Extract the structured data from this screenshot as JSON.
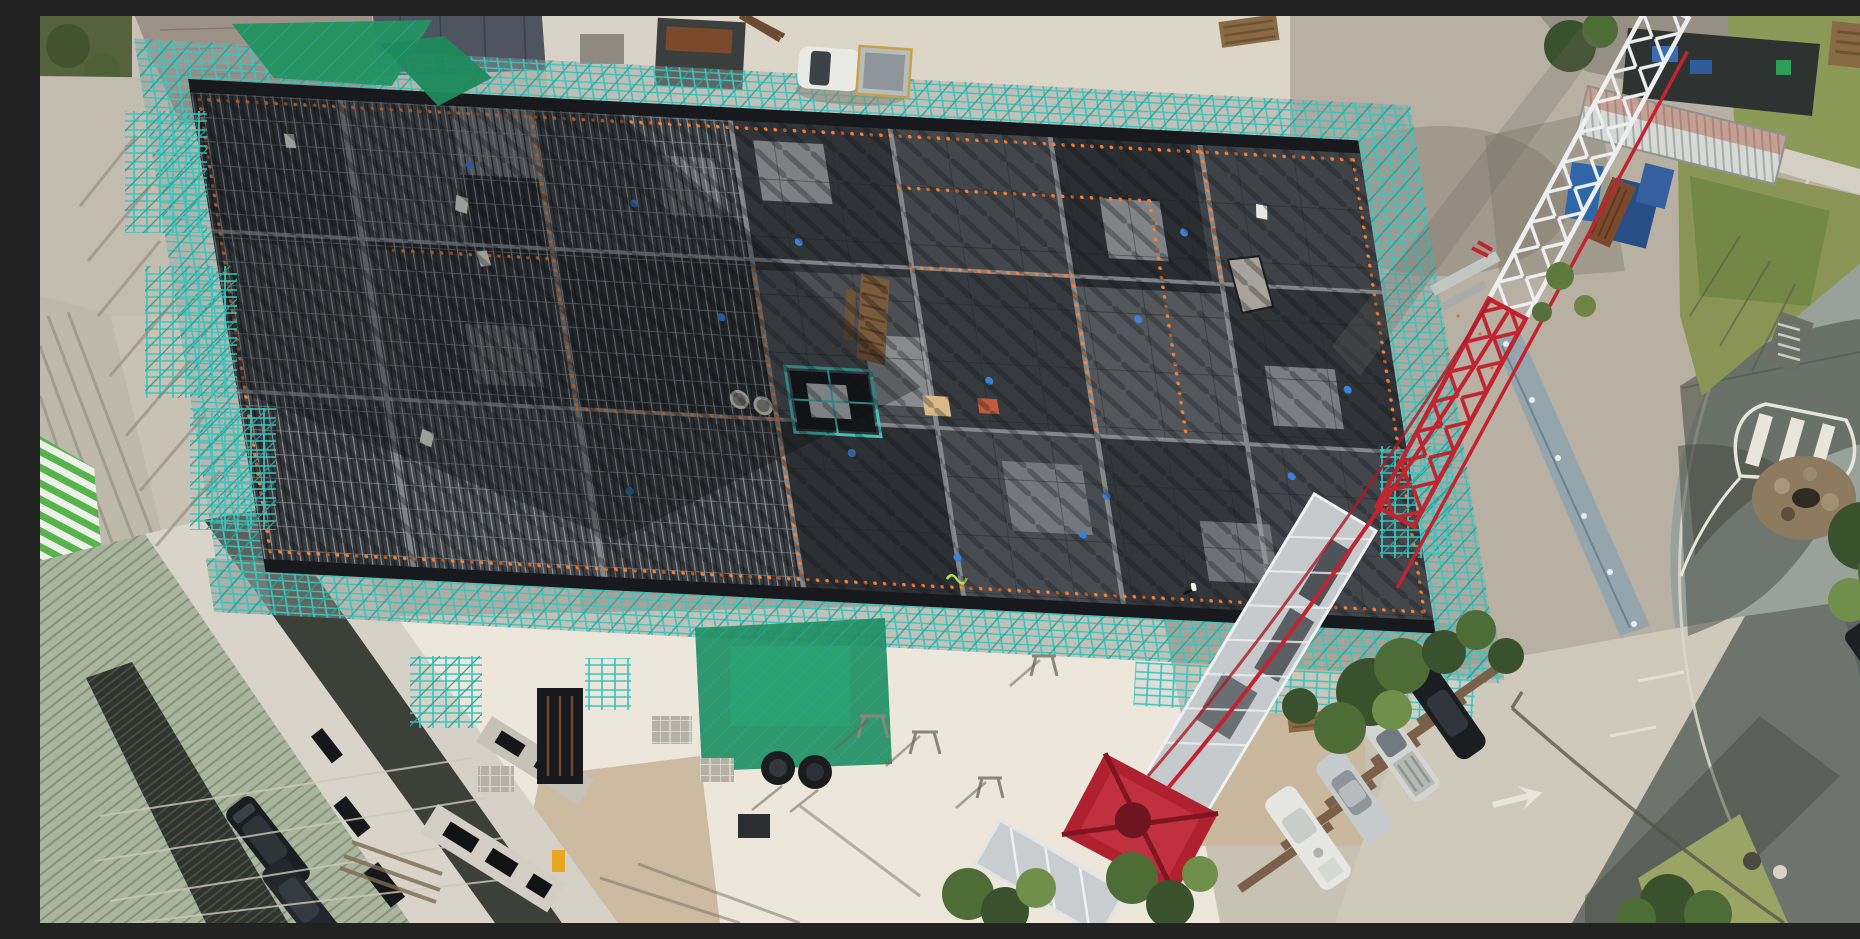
{
  "scene": {
    "type": "aerial-drone-photograph",
    "caption": "Top-down aerial view of a building construction site: a large rectangular concrete formwork deck with rebar, surrounded by teal scaffolding with green mesh, a red and white luffing tower crane, site sheds and containers, a curving asphalt road with a landscaped rock island, angled parking bays with cars, and neighbouring buildings with green louvres and ribbed roofs.",
    "objects": [
      "concrete-slab-under-construction",
      "rebar-mesh",
      "teal-scaffolding",
      "green-shade-mesh",
      "tower-crane-boom",
      "crane-machinery-deck",
      "crane-slewing-turret",
      "white-ute-truck",
      "parked-cars",
      "shipping-container",
      "blue-site-equipment",
      "curved-road",
      "painted-traffic-island",
      "rock-garden",
      "trees",
      "grass-verge",
      "neighbour-building-green-louvres",
      "ribbed-metal-roof",
      "driveway-with-black-cars",
      "precast-walls",
      "sand-stockpile",
      "orange-rebar-caps",
      "worker-on-slab"
    ],
    "counts": {
      "parking_bay_cars": 4,
      "driveway_black_cars": 2,
      "white_utes": 1,
      "cranes": 1
    }
  },
  "colors": {
    "base": "#c8c2b5",
    "concrete_light": "#dcd6c9",
    "concrete_bright": "#ece7da",
    "gravel": "#b7b0a3",
    "gravel_shadow": "#6f695e",
    "slab_dark": "#2b2e32",
    "slab_mid": "#3d4145",
    "slab_light": "#54585c",
    "panel_light": "#7d8184",
    "beam": "#9b9fa2",
    "dark_screen": "#17191c",
    "teal": "#3fc4bd",
    "teal_dark": "#27a39c",
    "mesh_green": "#22925f",
    "mesh_green2": "#2aa574",
    "crane_red": "#c2242f",
    "crane_white": "#edeff1",
    "crane_silver": "#c6cacd",
    "turret_red": "#b0212f",
    "road_light": "#99a29a",
    "road_dark": "#6e746d",
    "road_shadow": "#434841",
    "kerb": "#d9d6ca",
    "grass": "#8b9b57",
    "grass_dry": "#a3a368",
    "tree_dark": "#3a512d",
    "tree_mid": "#4e6c36",
    "tree_light": "#6f8f4a",
    "sand": "#c9b699",
    "sage_roof": "#a9b59c",
    "sage_rib": "#6c7565",
    "louver_green": "#55b44b",
    "white_wall": "#d8d4c9",
    "dark_band": "#383c35",
    "car_black": "#1b1e21",
    "car_silver": "#c8cbcd",
    "blue_equip": "#2f66a8",
    "rust": "#7b4a2c",
    "orange": "#ff8030",
    "blue_dot": "#3b82d6",
    "ply_tan": "#d9b98a",
    "ply_red": "#c25a3e",
    "yellow": "#e8a821",
    "shadow": "#14171a",
    "hoarding": "#8fa3b0",
    "white_paint": "#e8e5da",
    "skip_dark": "#3a3e3c",
    "roof_brown": "#90867b",
    "roof_slate": "#4e5560"
  }
}
